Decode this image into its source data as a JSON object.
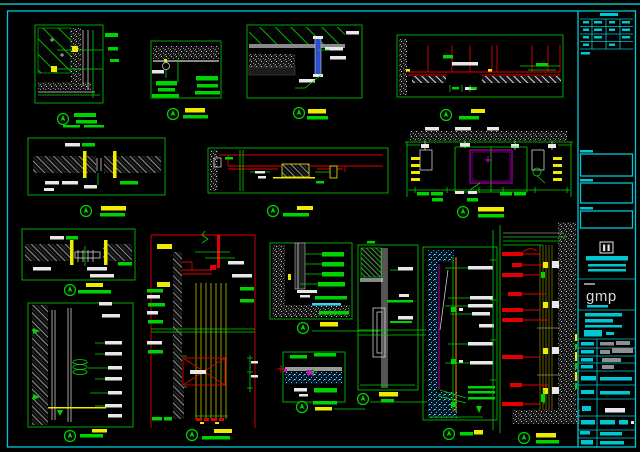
{
  "sheet": {
    "type": "cad-detail-sheet",
    "detail_count": 15,
    "colors": {
      "background": "#000000",
      "frame_cyan": "#00c8d2",
      "line_green": "#00d400",
      "highlight_yellow": "#f0ec00",
      "line_red": "#e30000",
      "accent_magenta": "#d400d4",
      "accent_blue": "#2a4fd0",
      "accent_orange": "#ff8800",
      "label_white": "#e8e8e8",
      "hatch_gray": "#8f8f8f"
    }
  },
  "title_block": {
    "logo_text": "gmp"
  }
}
